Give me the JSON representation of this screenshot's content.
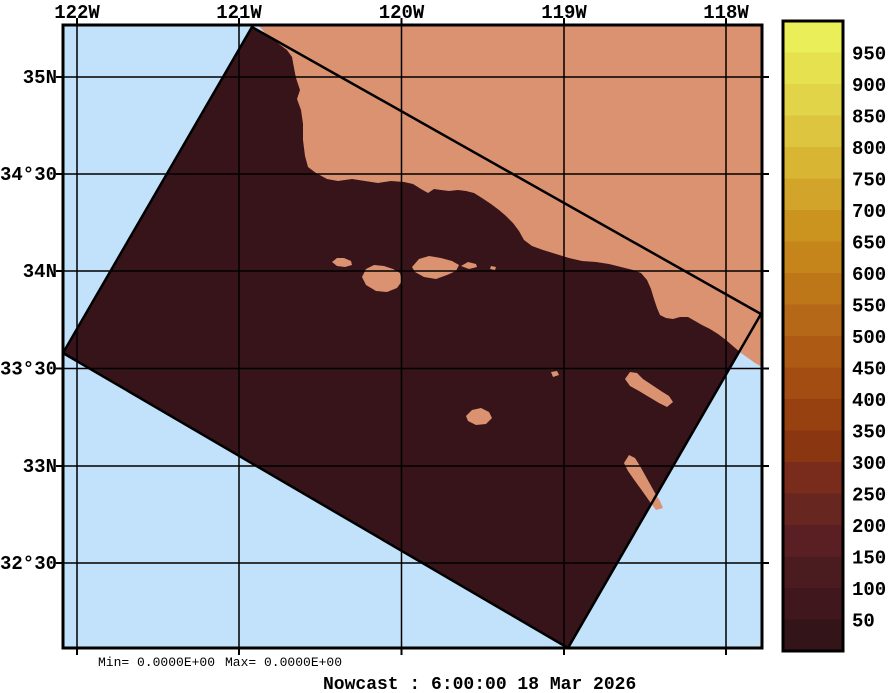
{
  "figure": {
    "caption": "Nowcast :  6:00:00  18 Mar 2026",
    "stats": {
      "min": "Min= 0.0000E+00",
      "max": "Max= 0.0000E+00"
    }
  },
  "axes": {
    "top": [
      "122W",
      "121W",
      "120W",
      "119W",
      "118W"
    ],
    "left": [
      "35N",
      "34°30",
      "34N",
      "33°30",
      "33N",
      "32°30"
    ]
  },
  "colorbar": {
    "labels": [
      "950",
      "900",
      "850",
      "800",
      "750",
      "700",
      "650",
      "600",
      "550",
      "500",
      "450",
      "400",
      "350",
      "300",
      "250",
      "200",
      "150",
      "100",
      "50"
    ],
    "colors_top_to_bottom": [
      "#eaee58",
      "#e6e14e",
      "#e2d449",
      "#ddc53f",
      "#d8b634",
      "#d2a52a",
      "#cb941e",
      "#c5851b",
      "#bd7618",
      "#b56817",
      "#ad5a15",
      "#a34d13",
      "#974111",
      "#8a3711",
      "#7a2c1c",
      "#682621",
      "#591f22",
      "#4b1c1f",
      "#3f171c",
      "#331419"
    ]
  },
  "colors": {
    "ocean": "#c2e1fa",
    "land": "#db9270",
    "swath": "#361419",
    "line": "#000000",
    "background": "#ffffff"
  },
  "chart_data": {
    "type": "heatmap",
    "title": "Nowcast :  6:00:00  18 Mar 2026",
    "x_ticks": [
      "122W",
      "121W",
      "120W",
      "119W",
      "118W"
    ],
    "y_ticks": [
      "35N",
      "34°30",
      "34N",
      "33°30",
      "33N",
      "32°30"
    ],
    "colorbar_range": [
      0,
      1000
    ],
    "colorbar_tick_step": 50,
    "field_min": 0,
    "field_max": 0,
    "notes": "Rotated rectangular radar nowcast swath over Southern California coastal waters; field uniformly 0 (darkest color) over ocean inside swath; land drawn on top; grid on; colorbar at right"
  }
}
